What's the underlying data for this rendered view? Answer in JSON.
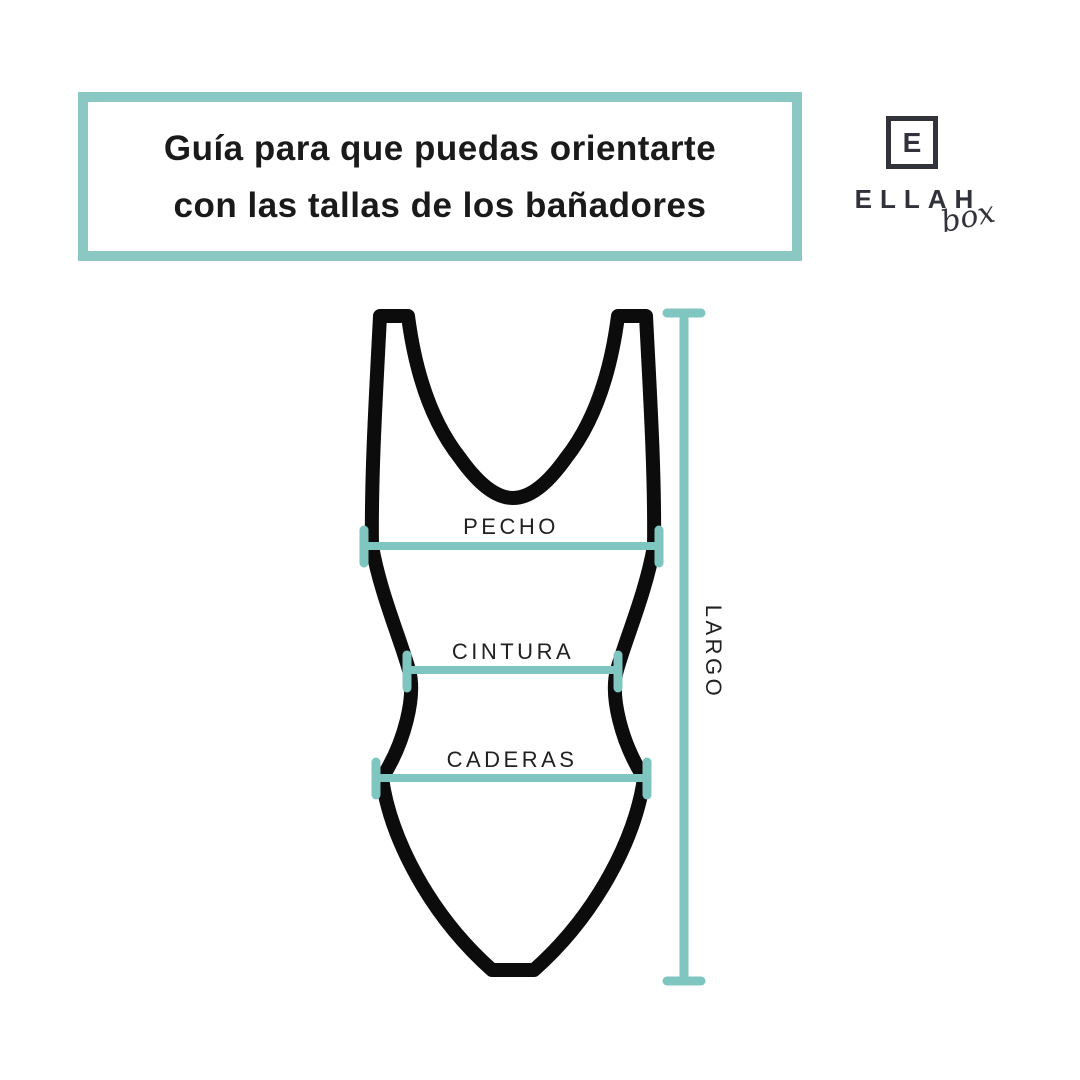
{
  "colors": {
    "teal": "#7fc5c0",
    "header_border": "#8bc8c4",
    "suit_stroke": "#0c0c0c",
    "title_ink": "#1a1a1a",
    "logo_ink": "#32333a"
  },
  "header": {
    "title_line1": "Guía para que puedas orientarte",
    "title_line2": "con las tallas de los bañadores"
  },
  "logo": {
    "initial": "E",
    "name": "ELLAH",
    "sub": "box"
  },
  "diagram": {
    "labels": {
      "chest": "PECHO",
      "waist": "CINTURA",
      "hips": "CADERAS",
      "length": "LARGO"
    }
  }
}
